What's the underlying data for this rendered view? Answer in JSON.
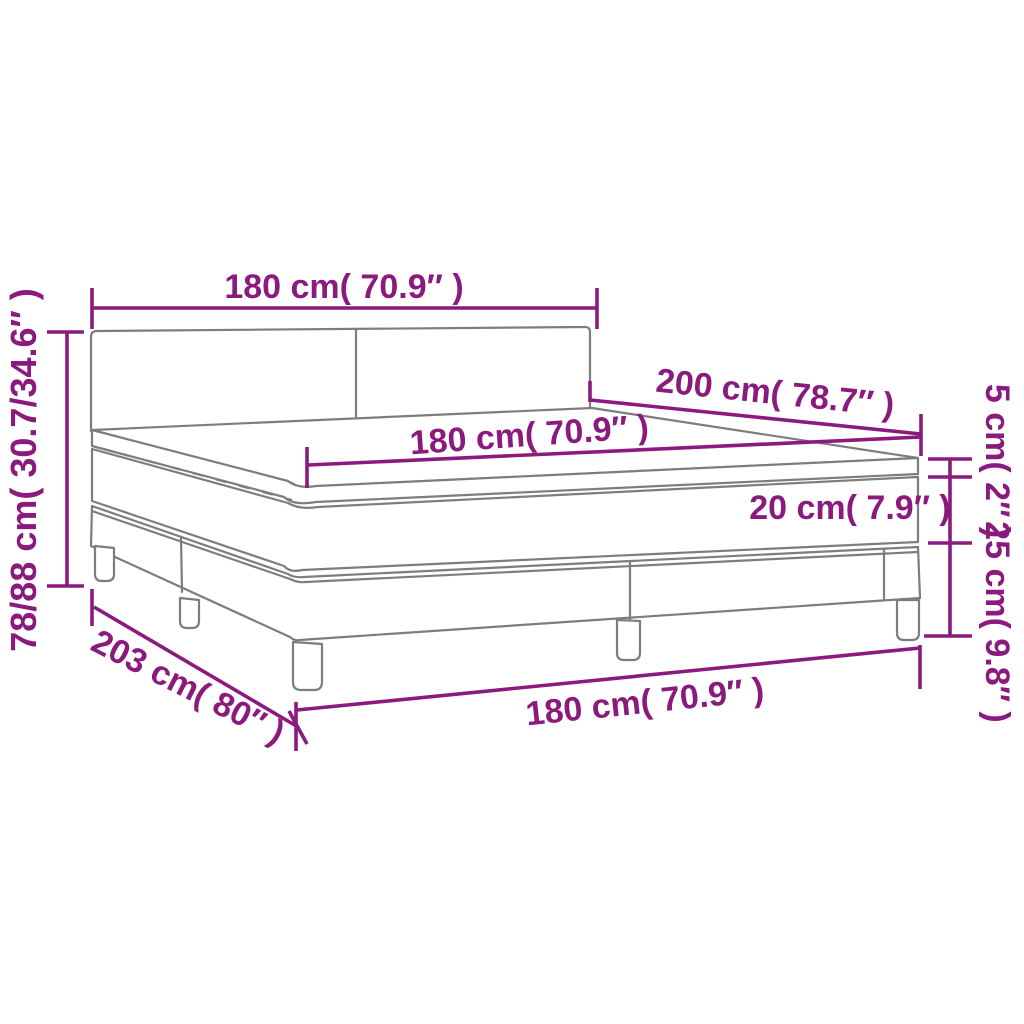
{
  "diagram": {
    "title": "Box spring bed with mattress and topper - dimension diagram",
    "accent_color": "#8B1A7E",
    "outline_color": "#7d7d7d",
    "background_color": "#ffffff",
    "measurements": [
      {
        "id": "headboard-width",
        "value_cm": "180",
        "value_in": "70.9",
        "label": "180 cm( 70.9″ )"
      },
      {
        "id": "overall-height",
        "value_cm": "78/88",
        "value_in": "30.7/34.6",
        "label": "78/88 cm( 30.7/34.6″ )"
      },
      {
        "id": "mattress-length",
        "value_cm": "200",
        "value_in": "78.7",
        "label": "200 cm( 78.7″ )"
      },
      {
        "id": "mattress-width",
        "value_cm": "180",
        "value_in": "70.9",
        "label": "180 cm( 70.9″ )"
      },
      {
        "id": "topper-height",
        "value_cm": "5",
        "value_in": "2",
        "label": "5 cm( 2″ )"
      },
      {
        "id": "mattress-height",
        "value_cm": "20",
        "value_in": "7.9",
        "label": "20 cm( 7.9″ )"
      },
      {
        "id": "base-height",
        "value_cm": "25",
        "value_in": "9.8",
        "label": "25 cm( 9.8″ )"
      },
      {
        "id": "overall-length",
        "value_cm": "203",
        "value_in": "80",
        "label": "203 cm( 80″ )"
      },
      {
        "id": "base-width",
        "value_cm": "180",
        "value_in": "70.9",
        "label": "180 cm( 70.9″ )"
      }
    ]
  }
}
